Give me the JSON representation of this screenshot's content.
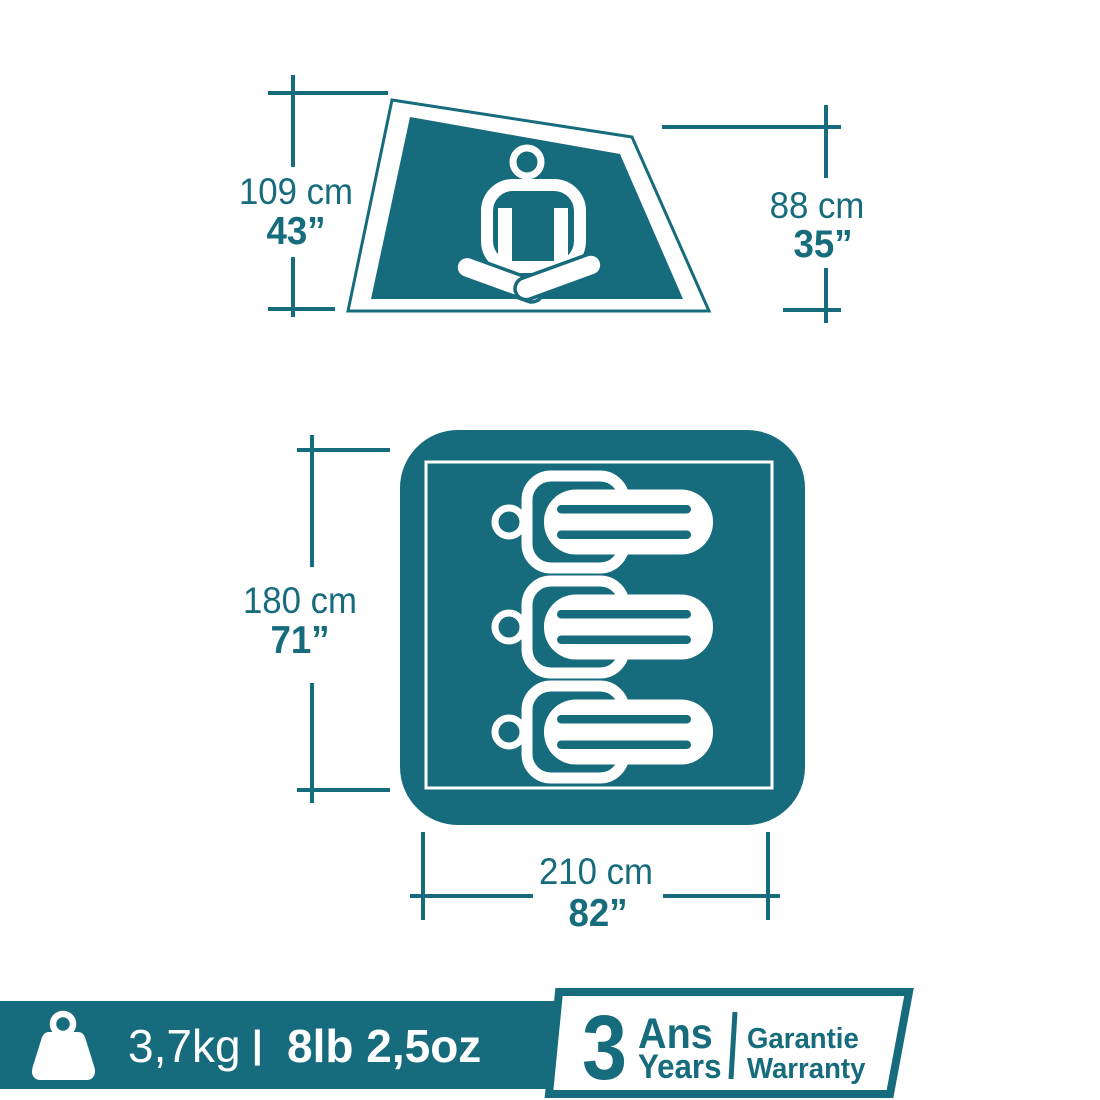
{
  "colors": {
    "teal": "#166B7C",
    "white": "#FFFFFF"
  },
  "top_diagram": {
    "description": "tent side view with seated person",
    "left_dimension": {
      "metric": "109 cm",
      "imperial": "43”"
    },
    "right_dimension": {
      "metric": "88 cm",
      "imperial": "35”"
    }
  },
  "floor_diagram": {
    "description": "tent floor plan with 3 sleeping persons",
    "capacity_persons": 3,
    "width_dimension": {
      "metric": "180 cm",
      "imperial": "71”"
    },
    "length_dimension": {
      "metric": "210 cm",
      "imperial": "82”"
    }
  },
  "footer": {
    "weight": {
      "metric": "3,7kg",
      "separator": "|",
      "imperial": "8lb 2,5oz"
    },
    "warranty": {
      "duration": "3",
      "unit_fr": "Ans",
      "unit_en": "Years",
      "label_fr": "Garantie",
      "label_en": "Warranty"
    }
  },
  "icons": {
    "weight": "kettlebell-icon",
    "seated": "meditating-person-icon",
    "sleeper": "sleeping-person-icon"
  }
}
